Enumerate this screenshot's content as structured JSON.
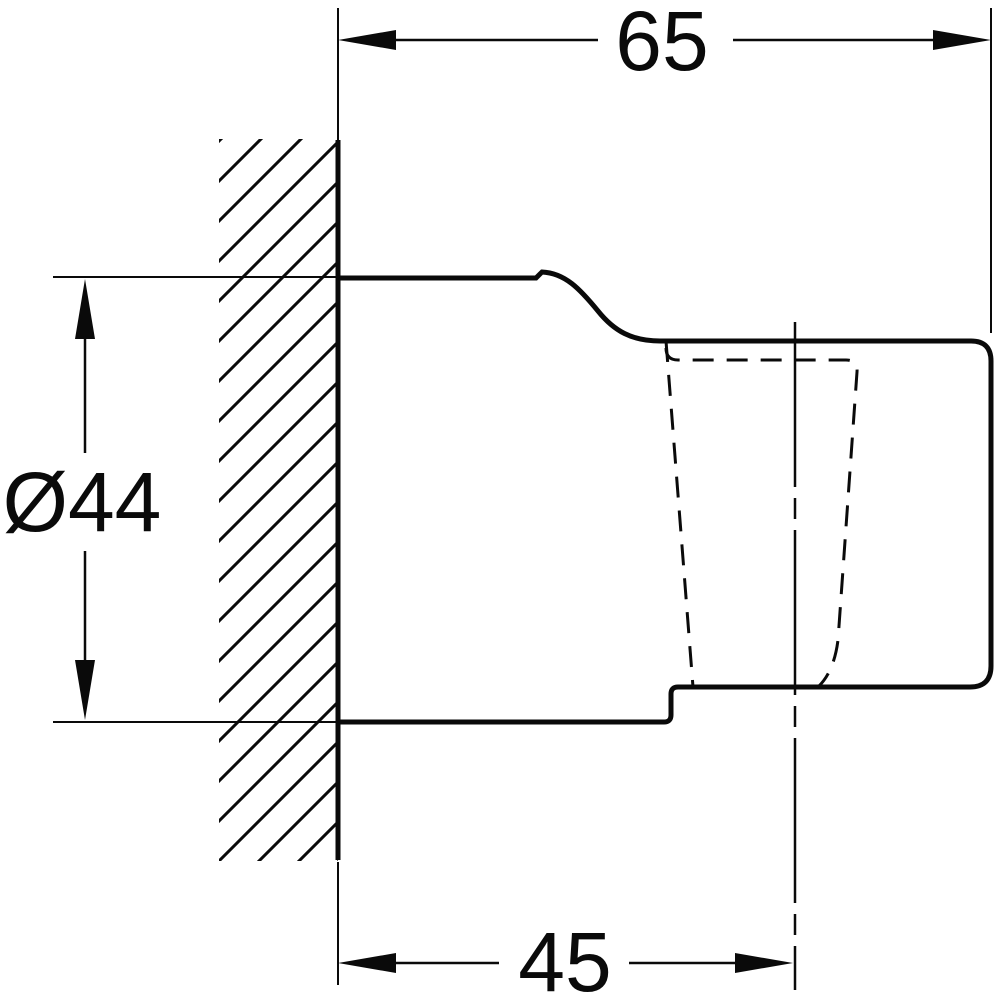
{
  "drawing": {
    "background_color": "#ffffff",
    "line_color": "#0a0a0a",
    "dimensions": {
      "top_width": "65",
      "diameter": "Ø44",
      "bottom_depth": "45"
    }
  }
}
